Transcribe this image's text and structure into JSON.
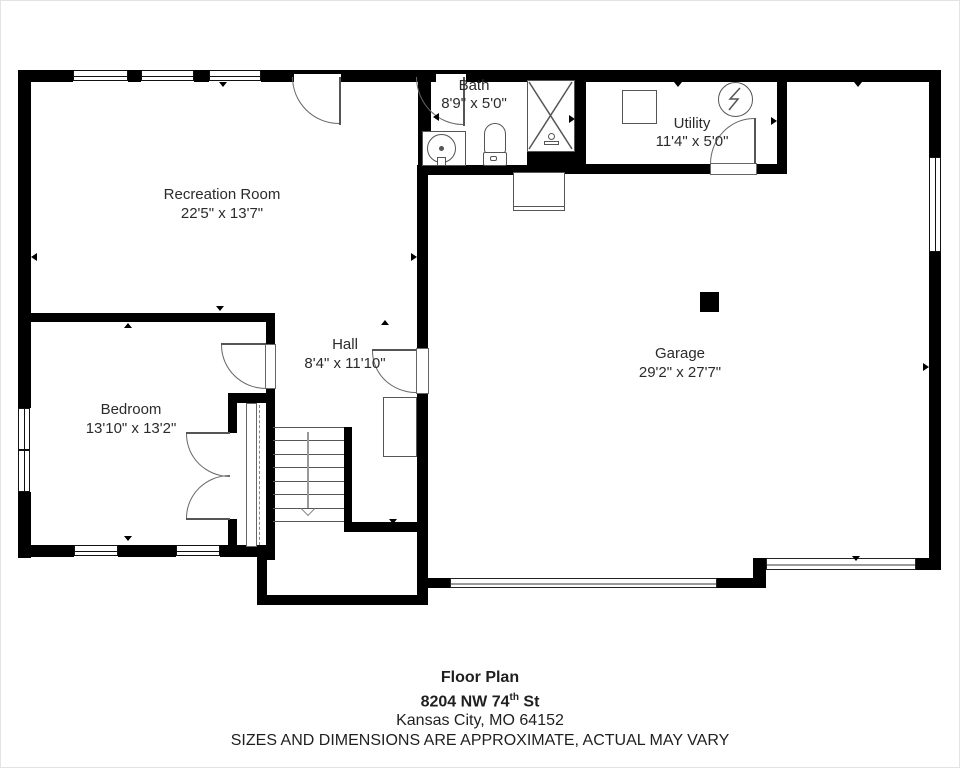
{
  "rooms": {
    "recreation": {
      "name": "Recreation Room",
      "dims": "22'5\" x 13'7\""
    },
    "bath": {
      "name": "Bath",
      "dims": "8'9\" x 5'0\""
    },
    "utility": {
      "name": "Utility",
      "dims": "11'4\" x 5'0\""
    },
    "garage": {
      "name": "Garage",
      "dims": "29'2\" x 27'7\""
    },
    "hall": {
      "name": "Hall",
      "dims": "8'4\" x 11'10\""
    },
    "bedroom": {
      "name": "Bedroom",
      "dims": "13'10\" x 13'2\""
    }
  },
  "title_block": {
    "line1": "Floor Plan",
    "address_num": "8204 NW 74",
    "address_sup": "th",
    "address_rest": " St",
    "city": "Kansas City, MO 64152",
    "disclaimer": "SIZES AND DIMENSIONS ARE APPROXIMATE, ACTUAL MAY VARY"
  },
  "colors": {
    "wall": "#000000",
    "fixture_line": "#555555",
    "text": "#2b2b2b",
    "background": "#ffffff"
  }
}
